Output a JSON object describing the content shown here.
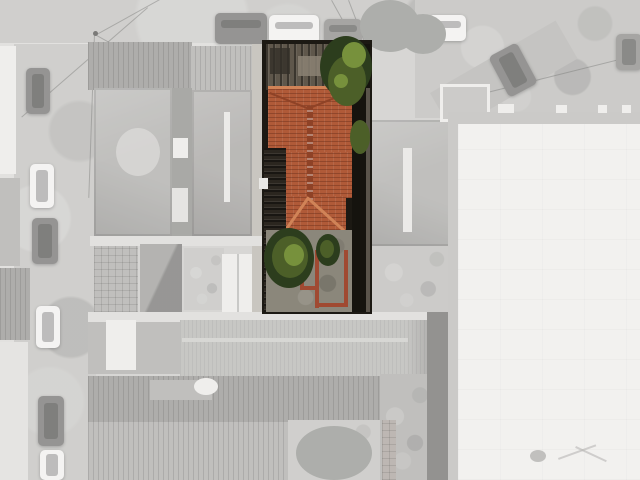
{
  "scene": {
    "type": "aerial drone photograph, top-down nadir view of a city block",
    "subject": "single property lot shown in full color while all surroundings are desaturated to pale gray",
    "highlighted_lot": {
      "description": "narrow deep lot: corrugated shed roof at the street, large terracotta clay-tile hip roof house, dark side service corridor, rear concrete yard with shrubs and low red-brick wall outlines",
      "roof_material": "terracotta clay tiles",
      "vegetation": "street-edge tree canopy and rear shrubs"
    },
    "surroundings": {
      "top": "horizontal street with parked cars and overhead power lines",
      "left": "vertical street with parked cars and row houses",
      "right": "large white flat-roof industrial warehouse with gray parapet",
      "center": "gray hip-roofed houses, outbuildings and courtyards",
      "bottom": "long ridged warehouse roof, corrugated sheds and a courtyard tree"
    },
    "vehicle_counts": {
      "top_street": 6,
      "left_street": 6
    }
  },
  "colors": {
    "base_gray": "#c8c7c4",
    "street": "#bfbebb",
    "street_dark": "#b0afac",
    "street_patch": "#cbcac7",
    "sidewalk": "#d7d6d3",
    "driveway": "#b9b8b5",
    "car_dark": "#6e6d6b",
    "car_dark2": "#858482",
    "car_white": "#f0efed",
    "roof_white": "#e9e8e5",
    "roof_white2": "#dcdbd8",
    "roof_mid": "#a9a8a5",
    "roof_mid2": "#a19f9c",
    "roof_dark": "#908f8c",
    "roof_dark2": "#878683",
    "roof_long": "#b3b2af",
    "ridge_white": "#e4e3e0",
    "ridge_light": "#c9c8c5",
    "stain": "#d0cfcc",
    "shadow_mid": "#8a8986",
    "shadow_dark": "#6b6a67",
    "tree_gray": "#8f918c",
    "brick_gray": "#a59d97",
    "warehouse_border": "#b8b7b4",
    "warehouse_white": "#edecea",
    "vent": "#aaa9a6",
    "seam": "#9c9b98",
    "line_dark": "#4a4946",
    "shed": "#5f574b",
    "shed_light": "#8b8173",
    "shed_dark": "#332f28",
    "tree_dark": "#2c3d1d",
    "tree_mid": "#4c5f28",
    "tree_light": "#77913c",
    "tile_base": "#b05a38",
    "tile_dark": "#8f4226",
    "tile_light": "#d08357",
    "tile_bright": "#e2a075",
    "corridor": "#2b261f",
    "yard_concrete": "#8b877b",
    "brick": "#a04a32",
    "lot_shadow": "#1c1913",
    "lot_shadow2": "#15130e",
    "wall_line": "#5a544b",
    "lot_wall": "#b5b1a9"
  }
}
